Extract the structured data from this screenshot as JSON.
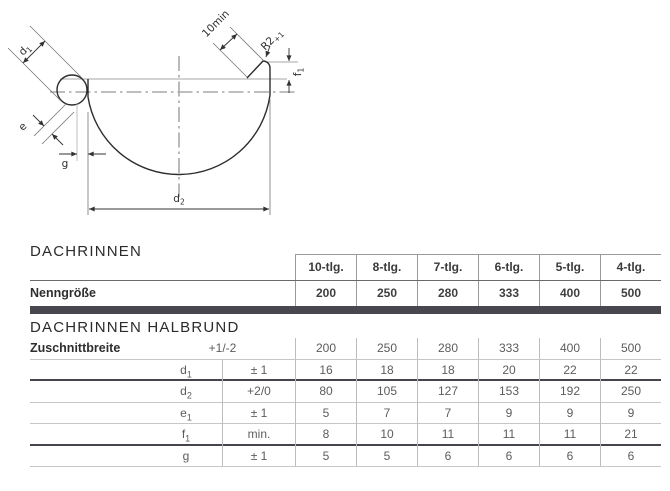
{
  "drawing": {
    "labels": {
      "d1": "d",
      "d1_sub": "1",
      "e": "e",
      "g": "g",
      "d2": "d",
      "d2_sub": "2",
      "ten_min": "10min",
      "r2": "R2",
      "r2_sub": "+1",
      "f1": "f",
      "f1_sub": "1"
    }
  },
  "colors": {
    "divider_bar": "#47474d"
  },
  "table": {
    "section1_title": "DACHRINNEN",
    "columns": [
      "10-tlg.",
      "8-tlg.",
      "7-tlg.",
      "6-tlg.",
      "5-tlg.",
      "4-tlg."
    ],
    "nenngroesse": {
      "label": "Nenngröße",
      "values": [
        "200",
        "250",
        "280",
        "333",
        "400",
        "500"
      ]
    },
    "section2_title": "DACHRINNEN HALBRUND",
    "rows": [
      {
        "label": "Zuschnittbreite",
        "sub": "",
        "tolerance": "+1/-2",
        "header_row": true,
        "values": [
          "200",
          "250",
          "280",
          "333",
          "400",
          "500"
        ]
      },
      {
        "label": "d",
        "sub": "1",
        "tolerance": "± 1",
        "values": [
          "16",
          "18",
          "18",
          "20",
          "22",
          "22"
        ]
      },
      {
        "label": "d",
        "sub": "2",
        "tolerance": "+2/0",
        "values": [
          "80",
          "105",
          "127",
          "153",
          "192",
          "250"
        ]
      },
      {
        "label": "e",
        "sub": "1",
        "tolerance": "± 1",
        "values": [
          "5",
          "7",
          "7",
          "9",
          "9",
          "9"
        ]
      },
      {
        "label": "f",
        "sub": "1",
        "tolerance": "min.",
        "values": [
          "8",
          "10",
          "11",
          "11",
          "11",
          "21"
        ]
      },
      {
        "label": "g",
        "sub": "",
        "tolerance": "± 1",
        "values": [
          "5",
          "5",
          "6",
          "6",
          "6",
          "6"
        ]
      }
    ]
  }
}
